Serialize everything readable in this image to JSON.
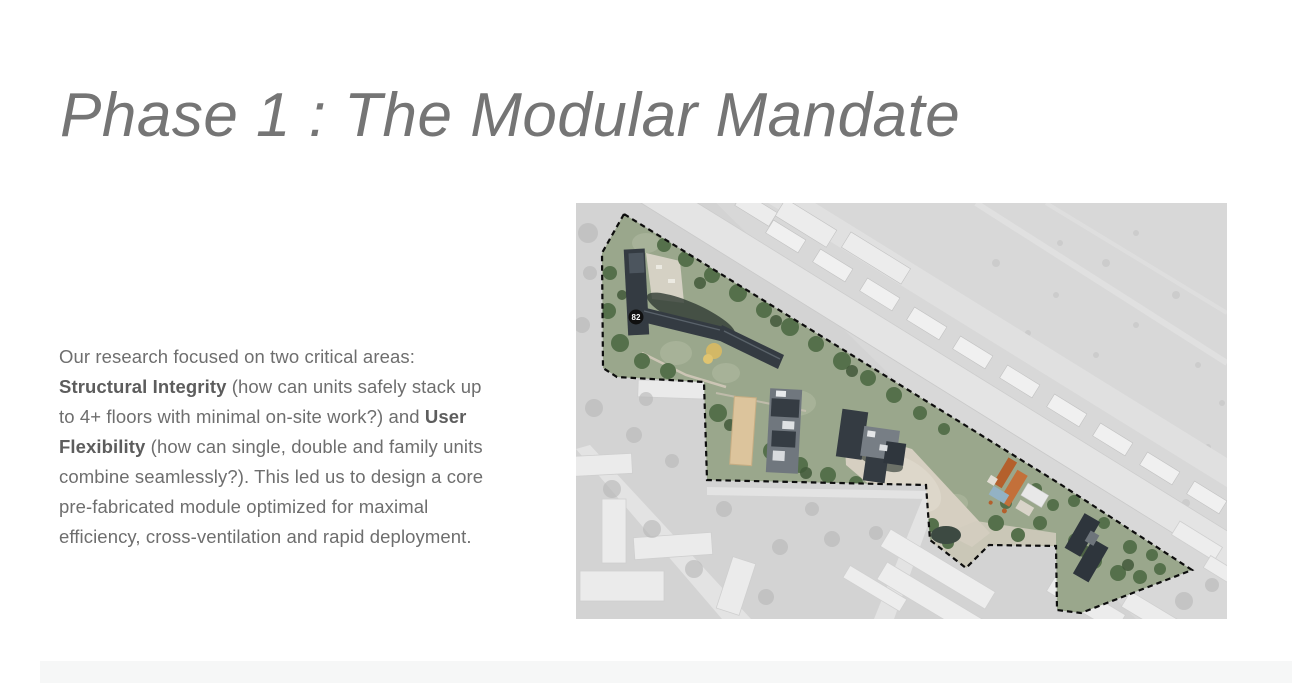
{
  "header": {
    "title": "Phase 1 : The Modular Mandate"
  },
  "article": {
    "paragraph": {
      "part1": "Our research focused on two critical areas: ",
      "bold1": "Structural Integrity",
      "part2": " (how can units safely stack up to 4+ floors with minimal on-site work?) and ",
      "bold2": "User Flexibility",
      "part3": " (how can single, double and family units combine seamlessly?). This led us to design a core pre-fabricated module optimized for maximal efficiency, cross-ventilation and rapid deployment."
    }
  },
  "map": {
    "kind": "aerial-site-plan",
    "marker_label": "82",
    "colors": {
      "outside_gray": "#d3d3d3",
      "road_light": "#e4e4e4",
      "site_green": "#55704b",
      "building_dark": "#343b42",
      "dirt_pale": "#d6cfc1",
      "roof_orange": "#bc6730",
      "boundary_dash": "#0d0d0d"
    }
  }
}
